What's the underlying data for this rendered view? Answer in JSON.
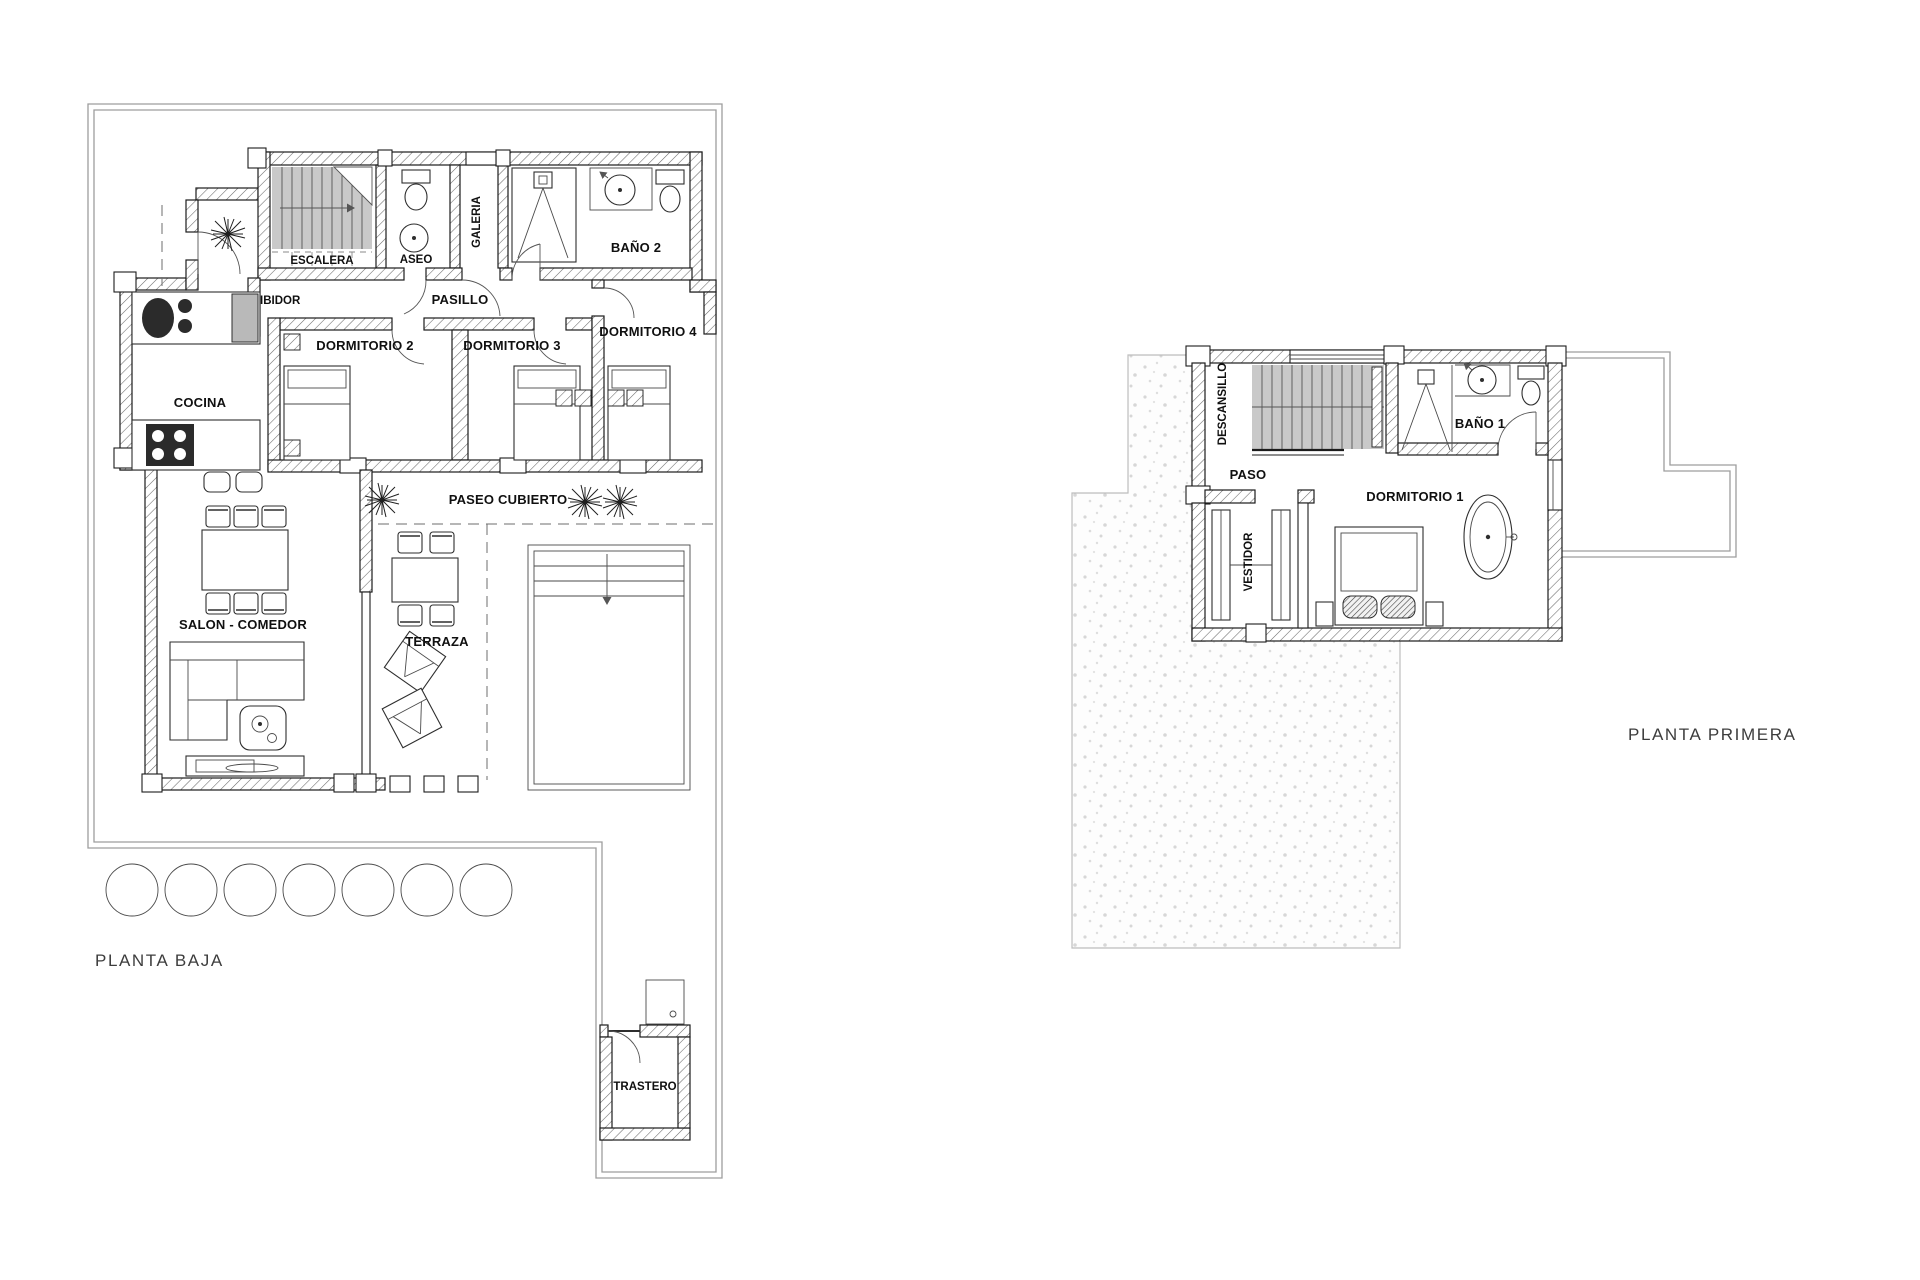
{
  "document": {
    "type": "architectural-floor-plan",
    "background": "#ffffff",
    "colors": {
      "wall_outline": "#1c1c1c",
      "hatch_line": "#6a6a6a",
      "stairs_fill": "#c9c9c9",
      "boundary_line": "#9d9d9d",
      "speckle_dot": "#d7d7d7",
      "label_text": "#101010",
      "title_text": "#3d3d3d"
    }
  },
  "plans": {
    "ground": {
      "title": "PLANTA BAJA",
      "rooms": {
        "escalera": "ESCALERA",
        "aseo": "ASEO",
        "galeria": "GALERIA",
        "bano2": "BAÑO 2",
        "acceso": "ACCESO",
        "recibidor": "RECIBIDOR",
        "pasillo": "PASILLO",
        "dormitorio2": "DORMITORIO 2",
        "dormitorio3": "DORMITORIO 3",
        "dormitorio4": "DORMITORIO 4",
        "cocina": "COCINA",
        "paseo": "PASEO CUBIERTO",
        "salon": "SALON - COMEDOR",
        "terraza": "TERRAZA",
        "trastero": "TRASTERO"
      }
    },
    "first": {
      "title": "PLANTA PRIMERA",
      "rooms": {
        "descansillo": "DESCANSILLO",
        "paso": "PASO",
        "bano1": "BAÑO 1",
        "dormitorio1": "DORMITORIO 1",
        "vestidor": "VESTIDOR"
      }
    }
  }
}
